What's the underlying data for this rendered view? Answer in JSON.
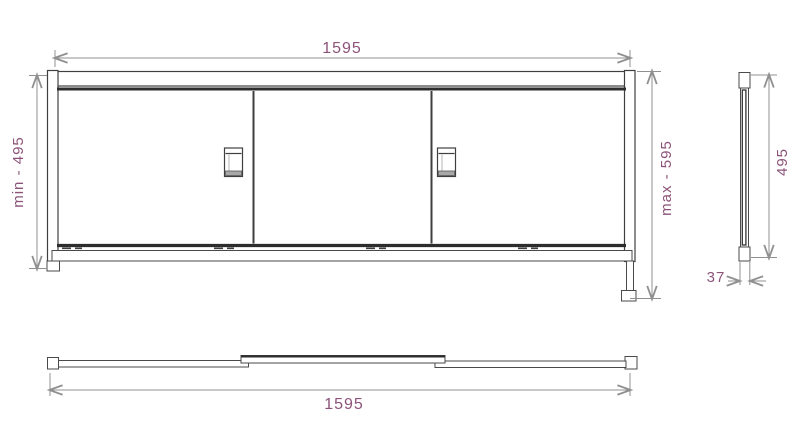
{
  "drawing": {
    "views": {
      "front": {
        "width_dim": "1595",
        "min_height_dim": "min - 495",
        "max_height_dim": "max - 595"
      },
      "side": {
        "height_dim": "495",
        "depth_dim": "37"
      },
      "plan": {
        "width_dim": "1595"
      }
    },
    "colors": {
      "object_line": "#3f3f3f",
      "track_line": "#2d2d2d",
      "dimension_line": "#909090",
      "dimension_text": "#8b5378",
      "background": "#ffffff"
    }
  }
}
